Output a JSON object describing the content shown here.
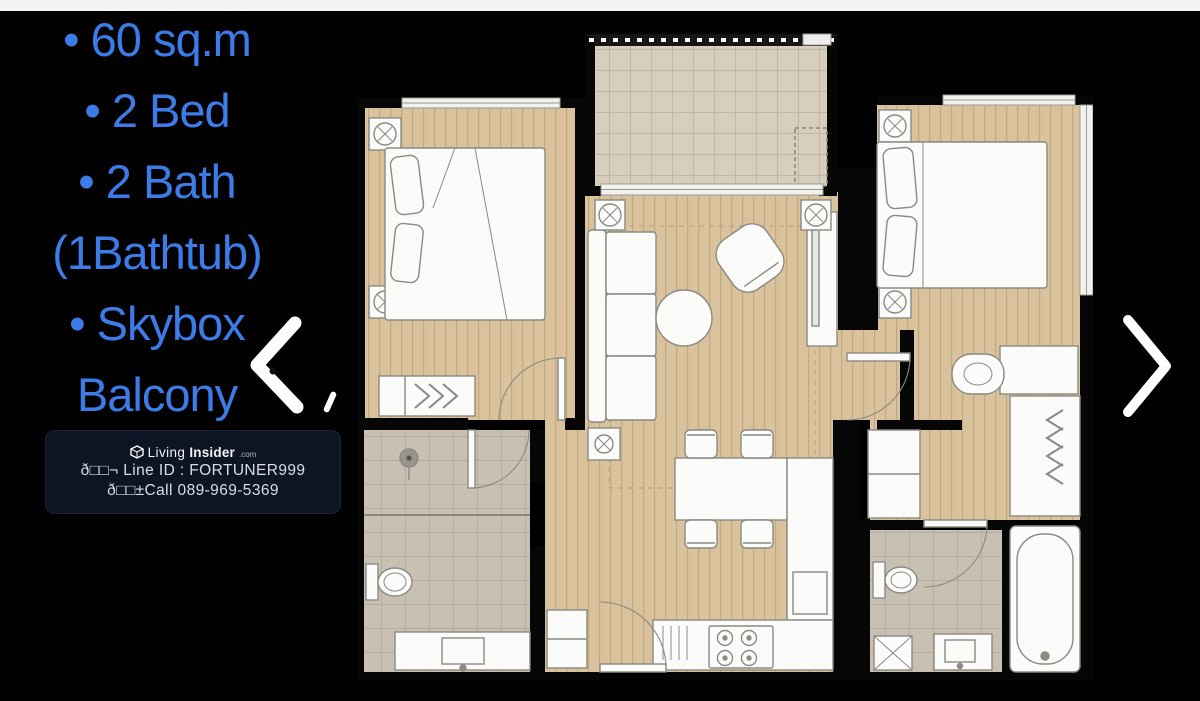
{
  "page": {
    "background": "#000000",
    "top_strip_color": "#f4f4f2"
  },
  "listing": {
    "features_color": "#3b7ce8",
    "features": [
      "• 60 sq.m",
      "• 2 Bed",
      "• 2 Bath",
      "(1Bathtub)",
      "• Skybox",
      "Balcony"
    ]
  },
  "watermark": {
    "brand": {
      "word1": "Living",
      "word2": "Insider",
      "tld": ".com"
    },
    "contact_line1": "ð□□¬ Line ID : FORTUNER999",
    "contact_line2": "ð□□±Call 089-969-5369",
    "background": "#0d1524",
    "text_color": "#d9dde3",
    "logo_icon": "living-insider-cube-logo"
  },
  "carousel": {
    "prev_icon": "chevron-left",
    "next_icon": "chevron-right",
    "arrow_color": "#ffffff"
  },
  "floorplan": {
    "type": "2-bedroom condo unit floor plan",
    "colors": {
      "wood_floor": "#d9c29c",
      "balcony_tile": "#d6cfbd",
      "bathroom_tile": "#c8c1b3",
      "wall": "#060606",
      "furniture": "#fbfbf9",
      "outline": "#8a8a84"
    }
  }
}
